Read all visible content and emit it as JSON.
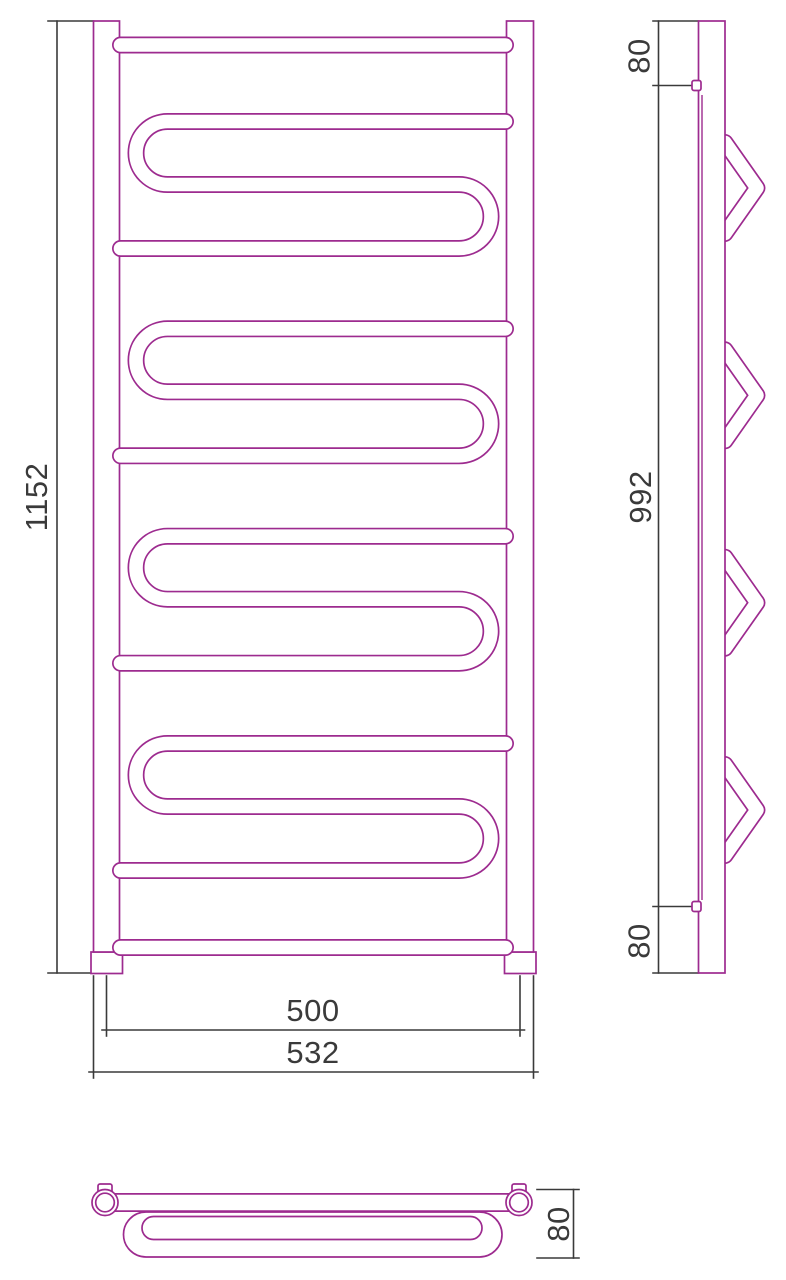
{
  "drawing_type": "towel-rail-technical-drawing",
  "colors": {
    "tube_outline": "#9d2b8f",
    "dimension_line": "#3a3a3a",
    "background": "#ffffff"
  },
  "front_view": {
    "height_mm": "1152",
    "rail_span_mm": "500",
    "overall_width_mm": "532"
  },
  "side_view": {
    "top_bracket_offset_mm": "80",
    "bracket_span_mm": "992",
    "bottom_bracket_offset_mm": "80"
  },
  "top_view": {
    "depth_mm": "80"
  }
}
